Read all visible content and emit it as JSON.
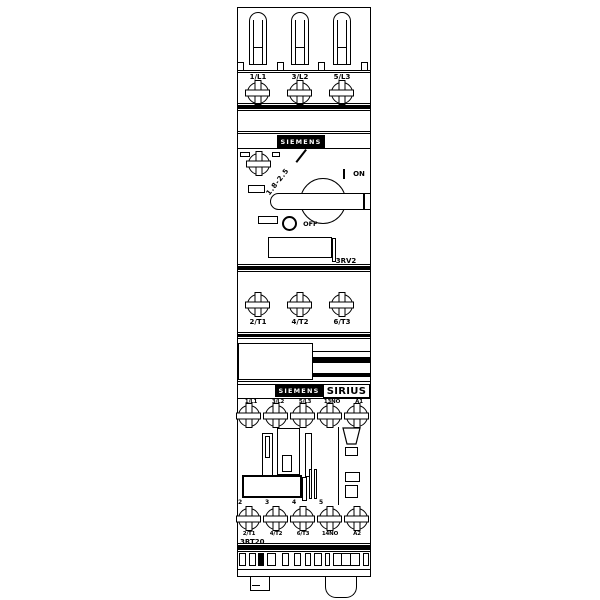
{
  "colors": {
    "line": "#000000",
    "background": "#ffffff"
  },
  "breaker": {
    "brand": "SIEMENS",
    "series_code": "3RV2",
    "line_terminals": [
      "1/L1",
      "3/L2",
      "5/L3"
    ],
    "load_terminals": [
      "2/T1",
      "4/T2",
      "6/T3"
    ],
    "current_setting_range": "1.8-2.5",
    "on_symbol": "I",
    "on_label": "ON",
    "off_symbol": "O",
    "off_label": "OFF"
  },
  "contactor": {
    "brand": "SIEMENS",
    "series_name": "SIRIUS",
    "series_code": "3RT20",
    "top_terminals": [
      "1/L1",
      "3/L2",
      "5/L3",
      "13NO",
      "A1"
    ],
    "bottom_terminals": [
      "2/T1",
      "4/T2",
      "6/T3",
      "14NO",
      "A2"
    ],
    "pole_numbers": [
      "2",
      "3",
      "4",
      "5"
    ]
  }
}
